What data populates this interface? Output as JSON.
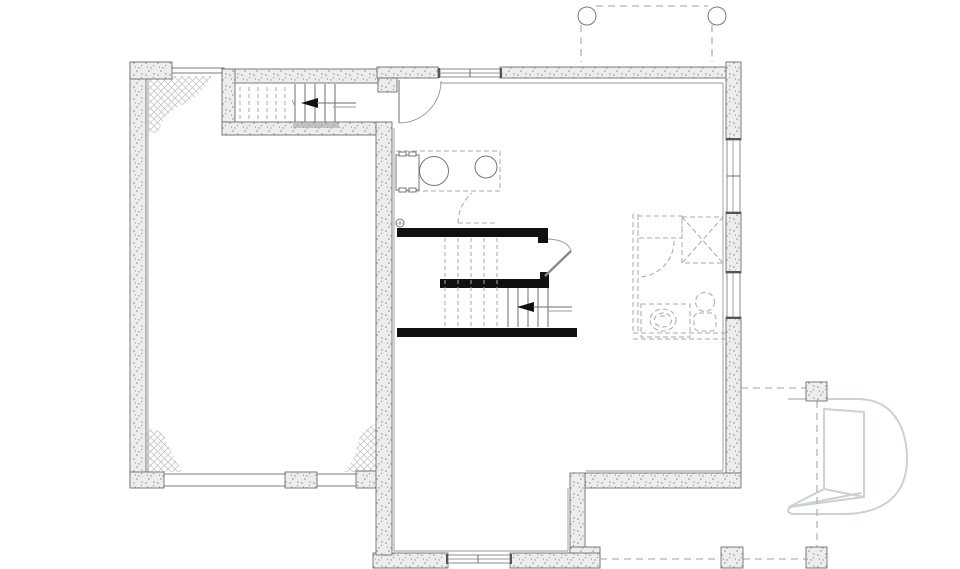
{
  "document": {
    "type": "architectural floor plan",
    "level": "basement / foundation plan",
    "visible_text": [],
    "orientation": "plan view"
  },
  "colors": {
    "background": "#ffffff",
    "wall_fill": "#ededed",
    "wall_speckle": "#8f8f8f",
    "wall_stroke": "#6f6f6f",
    "line": "#6e6e6e",
    "line_light": "#9a9a9a",
    "bearing_wall": "#111111",
    "dashed_fixture": "#a8a8a8",
    "deck_dash": "#b4b4b4",
    "hatch_lines": "#c6c6c6",
    "watermark": "#ccd1d4"
  },
  "legend": {
    "rooms": [
      {
        "name": "garage",
        "notes": "left room, cross-hatched soil patches in three corners, pier blocks along thin frost walls"
      },
      {
        "name": "upper-stair-enclosure",
        "notes": "top-left, straight stair with left-pointing direction arrow"
      },
      {
        "name": "laundry-area",
        "notes": "washer, round laundry tub, utility sink on dashed counter, floor drain"
      },
      {
        "name": "main-basement-area",
        "notes": "open area around central stair"
      },
      {
        "name": "future-bathroom",
        "notes": "dashed (future) shower, vanity sink and toilet at right"
      },
      {
        "name": "rear-bump-out",
        "notes": "bottom-centre projection with basement window"
      }
    ],
    "stairs": [
      {
        "name": "upper-left-stair",
        "dashed_treads": 6,
        "solid_treads": 5,
        "arrow_direction": "left"
      },
      {
        "name": "central-stair",
        "dashed_treads": 5,
        "solid_treads": 5,
        "arrow_direction": "left"
      }
    ],
    "fixtures": [
      "washer",
      "laundry-tub",
      "utility-sink",
      "floor-drain",
      "shower",
      "vanity-sink",
      "toilet"
    ],
    "windows": 4,
    "door_swings": 4,
    "porch_posts_round": 2,
    "deck_posts_square": 3,
    "watermark": "stylized letter-D door logo"
  }
}
